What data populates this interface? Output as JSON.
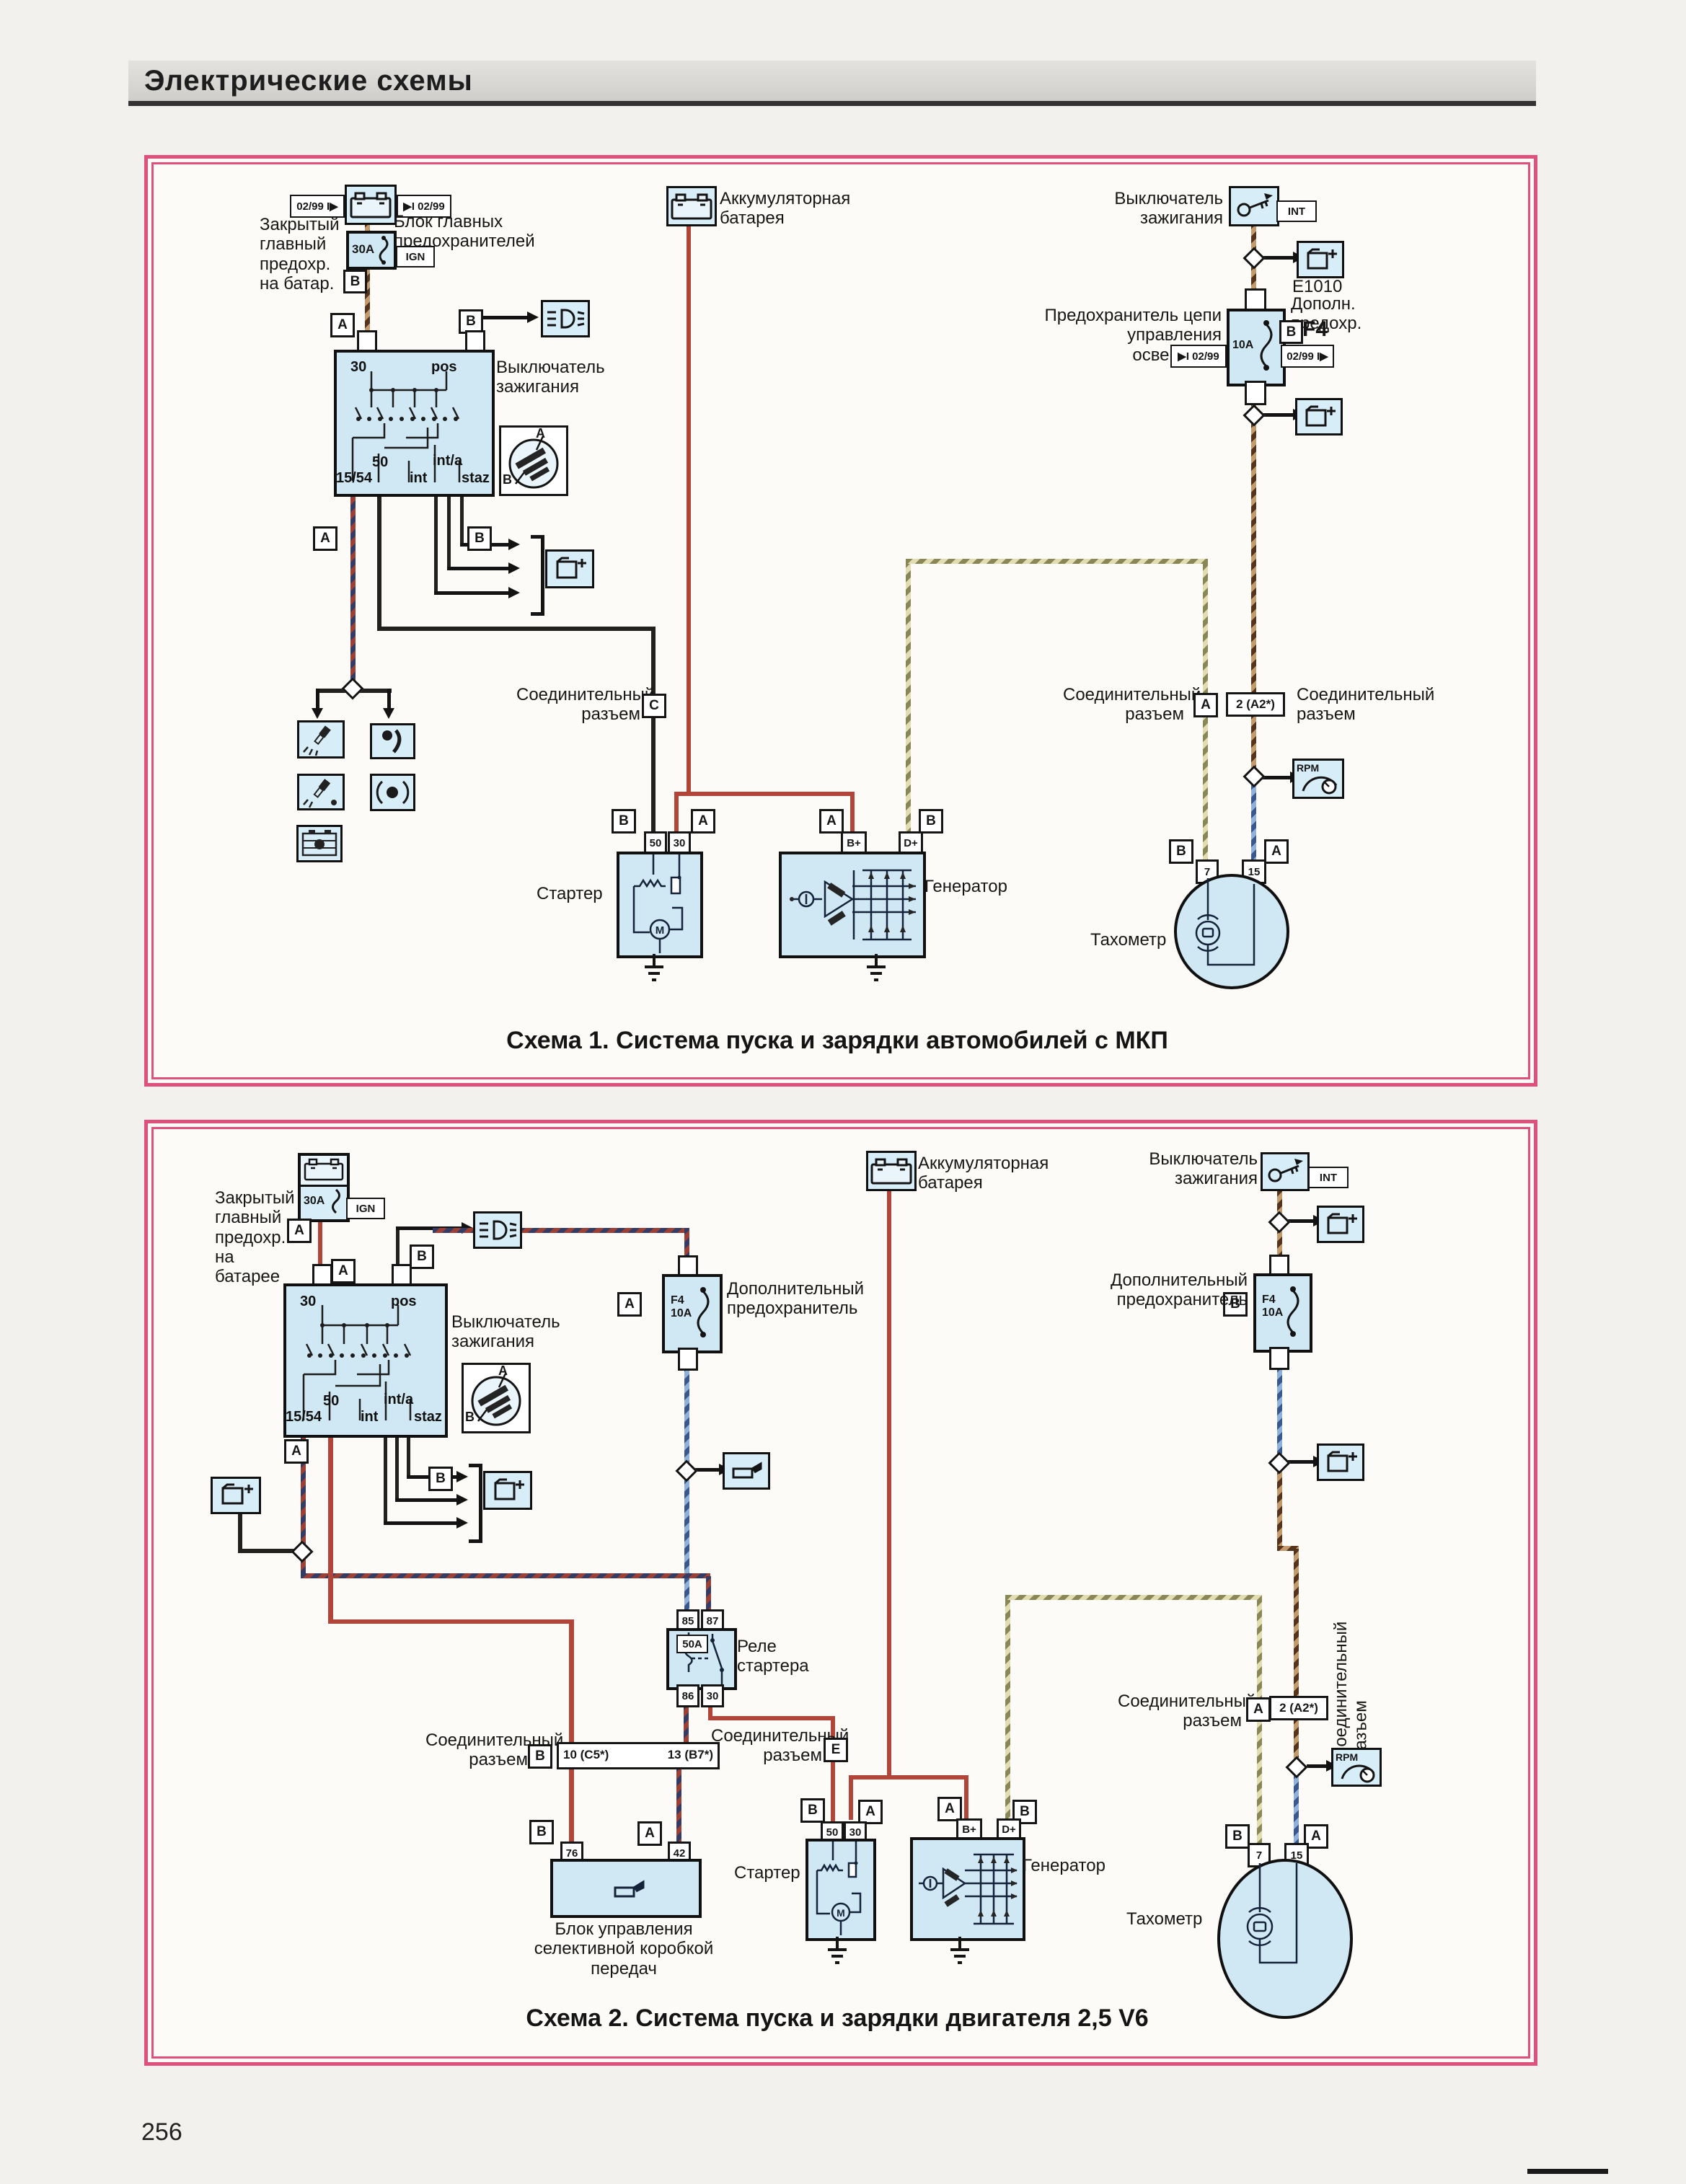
{
  "page": {
    "title": "Электрические схемы",
    "page_number": "256"
  },
  "sym": {
    "A": "A",
    "B": "B",
    "C": "C",
    "E": "E",
    "M": "M",
    "int": "INT",
    "ign": "IGN",
    "rpm": "RPM"
  },
  "dates": {
    "out": "02/99 I▶",
    "in": "▶I 02/99"
  },
  "labels": {
    "connector": "Соединительный\nразъем",
    "battery": "Аккумуляторная\nбатарея",
    "ignition": "Выключатель\nзажигания",
    "starter": "Стартер",
    "generator": "Генератор",
    "tach": "Тахометр",
    "addfuse": "Дополнительный\nпредохранитель"
  },
  "d1": {
    "caption": "Схема 1. Система пуска и зарядки автомобилей с МКП",
    "closed_fuse": "Закрытый\nглавный\nпредохр.\nна батар.",
    "fuse_block": "Блок главных\nпредохранителей 1",
    "fuse30": "30A",
    "light_fuse": "Предохранитель цепи\nуправления освещения",
    "fuse10": "10A",
    "f4": "F4",
    "e1010": "E1010",
    "addfuse_short": "Дополн.\nпредохр.",
    "conn_a2": "2 (A2*)",
    "sw_top": [
      "30",
      "pos"
    ],
    "sw_bottom": [
      "15/54",
      "50",
      "int",
      "int/a",
      "staz"
    ],
    "starter_t": [
      "50",
      "30"
    ],
    "gen_t": [
      "B+",
      "D+"
    ],
    "tach_t": [
      "7",
      "15"
    ]
  },
  "d2": {
    "caption": "Схема 2. Система пуска и зарядки двигателя 2,5 V6",
    "closed_fuse": "Закрытый\nглавный\nпредохр.\nна батарее",
    "fuse30": "30A",
    "fuse_f4": "F4\n10A",
    "relay": "Реле\nстартера",
    "relay_amp": "50A",
    "relay_t": [
      "85",
      "87",
      "86",
      "30"
    ],
    "bar_left": "10 (C5*)",
    "bar_right": "13 (B7*)",
    "gcu": "Блок управления\nселективной коробкой\nпередач",
    "conn_a2": "2 (A2*)",
    "block_t": [
      "76",
      "42"
    ],
    "sw_top": [
      "30",
      "pos"
    ],
    "sw_bottom": [
      "15/54",
      "50",
      "int",
      "int/a",
      "staz"
    ],
    "starter_t": [
      "50",
      "30"
    ],
    "gen_t": [
      "B+",
      "D+"
    ],
    "tach_t": [
      "7",
      "15"
    ]
  }
}
